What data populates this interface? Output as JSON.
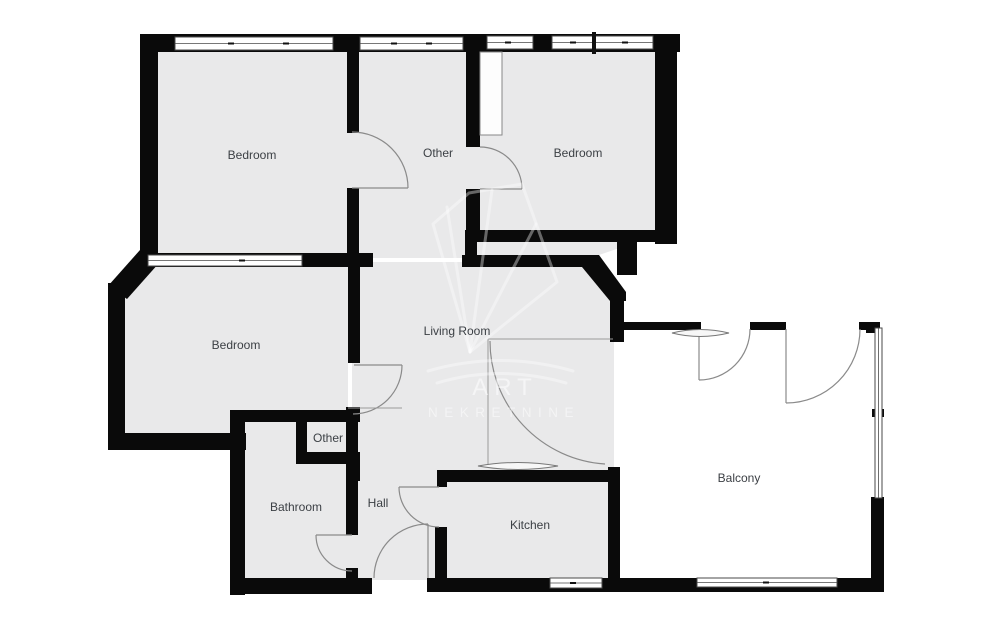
{
  "page": {
    "background": "#ffffff"
  },
  "colors": {
    "room_fill": "#e9e9ea",
    "wall": "#0a0a0a",
    "door_arc": "#8a8a8a",
    "label_text": "#3c4045",
    "watermark_text": "#ffffff",
    "balcony_fill": "#ffffff"
  },
  "rooms": {
    "bedroom_top_left": {
      "label": "Bedroom"
    },
    "other_top": {
      "label": "Other"
    },
    "bedroom_top_right": {
      "label": "Bedroom"
    },
    "bedroom_left": {
      "label": "Bedroom"
    },
    "living_room": {
      "label": "Living Room"
    },
    "other_small": {
      "label": "Other"
    },
    "bathroom": {
      "label": "Bathroom"
    },
    "hall": {
      "label": "Hall"
    },
    "kitchen": {
      "label": "Kitchen"
    },
    "balcony": {
      "label": "Balcony"
    }
  },
  "watermark": {
    "title": "ART",
    "subtitle": "NEKRETNINE"
  }
}
